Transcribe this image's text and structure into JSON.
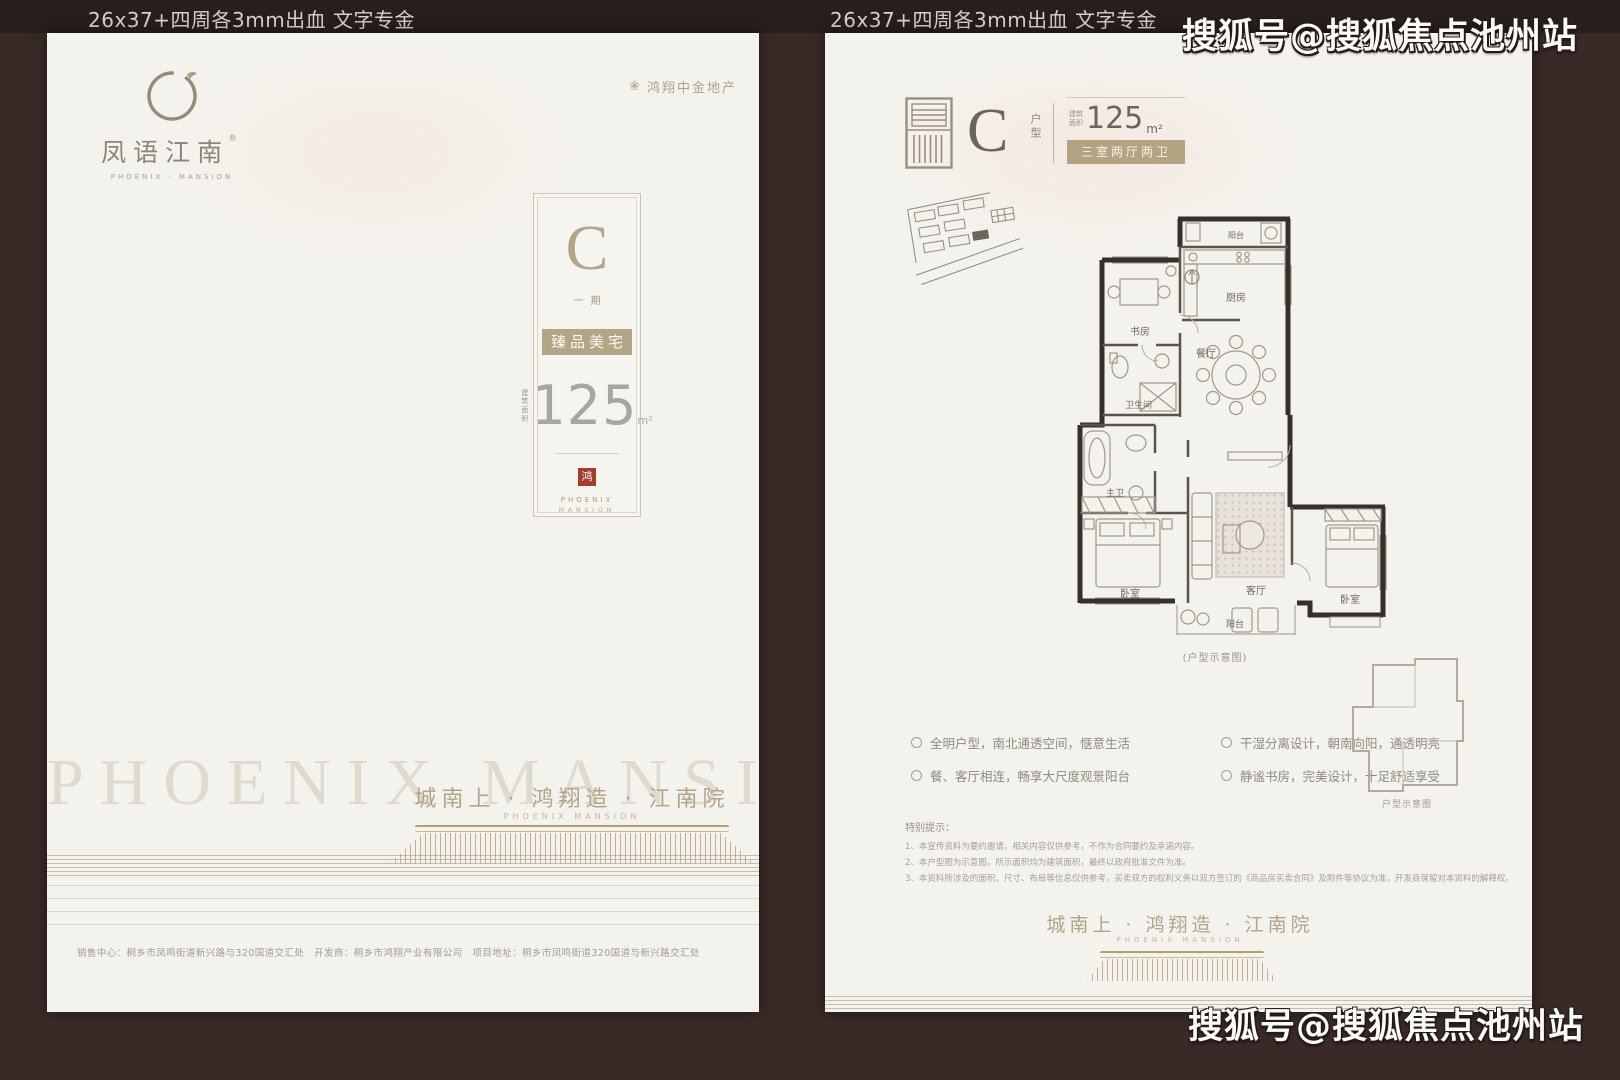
{
  "annotations": {
    "spec_label": "26x37+四周各3mm出血 文字专金",
    "watermark": "搜狐号@搜狐焦点池州站"
  },
  "brand": {
    "logo_name": "凤语江南",
    "logo_reg": "®",
    "logo_en": "PHOENIX · MANSION",
    "developer": "鸿翔中金地产",
    "emblem_glyph": "❀",
    "tagline": "城南上 · 鸿翔造 · 江南院",
    "tagline_en": "PHOENIX MANSION",
    "ghost_text": "PHOENIX MANSION",
    "colors": {
      "accent_tan": "#b3a687",
      "seal_red": "#a63c2c",
      "page_bg": "#f4f2ed",
      "backdrop": "#3a2b28"
    }
  },
  "left_page": {
    "unit_card": {
      "letter": "C",
      "phase": "一期",
      "banner": "臻品美宅",
      "area_label_l1": "建筑",
      "area_label_l2": "面积",
      "area_value": "125",
      "area_unit": "m²",
      "seal_char": "鸿",
      "brand_line1": "PHOENIX",
      "brand_line2": "MANSION"
    },
    "footer_line": "销售中心：桐乡市凤鸣街道新兴路与320国道交汇处　开发商：桐乡市鸿翔产业有限公司　项目地址：桐乡市凤鸣街道320国道与新兴路交汇处"
  },
  "right_page": {
    "header": {
      "letter": "C",
      "type_label": "户型",
      "area_label_l1": "建筑",
      "area_label_l2": "面积",
      "area_value": "125",
      "area_unit": "m²",
      "layout_text": "三室两厅两卫"
    },
    "floor_plan": {
      "caption": "(户型示意图)",
      "labels": {
        "balcony_top": "阳台",
        "kitchen": "厨房",
        "study": "书房",
        "bath": "卫生间",
        "dining": "餐厅",
        "master_bath": "主卫",
        "bedroom_left": "卧室",
        "living": "客厅",
        "bedroom_right": "卧室",
        "balcony_bottom": "阳台"
      }
    },
    "mini_plan_caption": "户型示意图",
    "features": [
      "全明户型，南北通透空间，惬意生活",
      "干湿分离设计，朝南向阳，通透明亮",
      "餐、客厅相连，畅享大尺度观景阳台",
      "静谧书房，完美设计，十足舒适享受"
    ],
    "disclaimer": {
      "title": "特别提示：",
      "lines": [
        "1、本宣传资料为要约邀请，相关内容仅供参考，不作为合同要约及承诺内容。",
        "2、本户型图为示意图，所示面积均为建筑面积，最终以政府批准文件为准。",
        "3、本资料所涉及的面积、尺寸、布局等信息仅供参考，买卖双方的权利义务以双方签订的《商品房买卖合同》及附件等协议为准，开发商保留对本资料的解释权。"
      ]
    }
  }
}
